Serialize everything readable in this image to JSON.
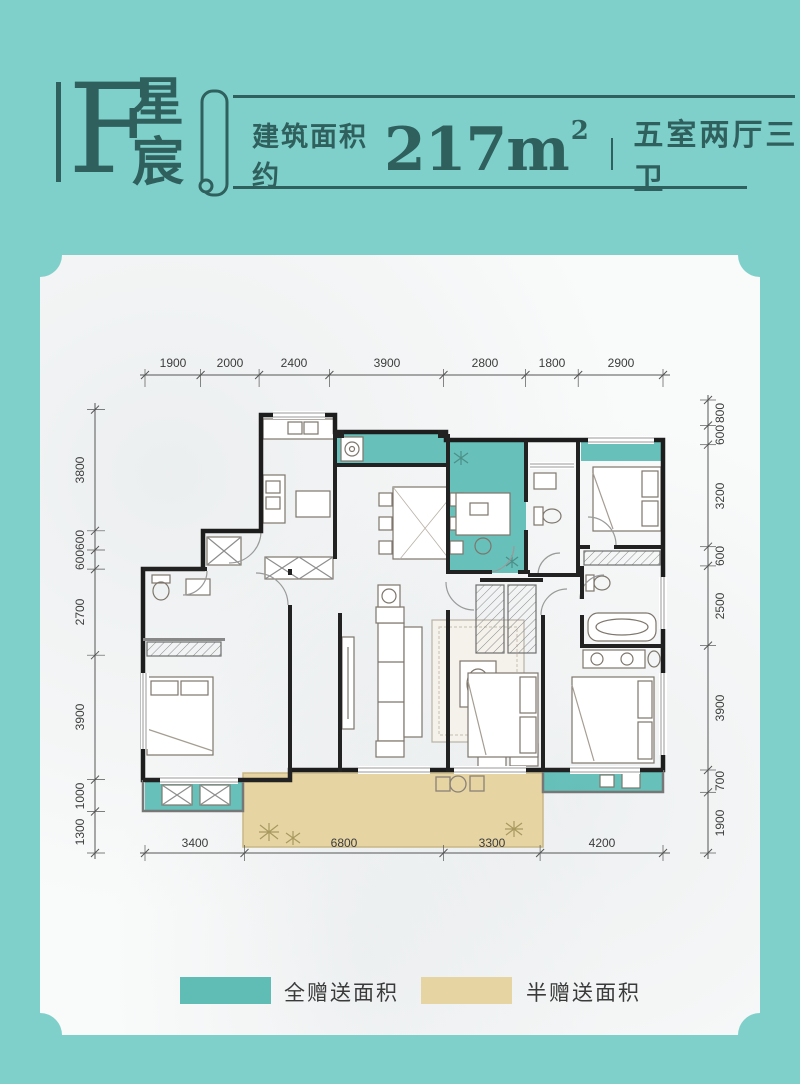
{
  "header": {
    "unit_letter": "F",
    "unit_name_chars": [
      "星",
      "宸"
    ],
    "area_prefix": "建筑面积约",
    "area_value": "217m",
    "area_sup": "2",
    "layout_text": "五室两厅三卫"
  },
  "dimensions": {
    "top": [
      "1900",
      "2000",
      "2400",
      "3900",
      "2800",
      "1800",
      "2900"
    ],
    "bottom": [
      "3400",
      "6800",
      "3300",
      "4200"
    ],
    "left": [
      "3800",
      "600",
      "600",
      "2700",
      "3900",
      "1000",
      "1300"
    ],
    "right": [
      "800",
      "600",
      "3200",
      "600",
      "2500",
      "3900",
      "700",
      "1900"
    ]
  },
  "legend": {
    "full_gift": {
      "label": "全赠送面积",
      "color": "#5fbdb5"
    },
    "half_gift": {
      "label": "半赠送面积",
      "color": "#e6d4a3"
    }
  },
  "colors": {
    "background": "#7fd0ca",
    "ink": "#2f605d",
    "card": "#f9fafa",
    "gift_full": "#5fbdb5",
    "gift_half": "#e6d4a3",
    "wall": "#1d1d1d"
  }
}
